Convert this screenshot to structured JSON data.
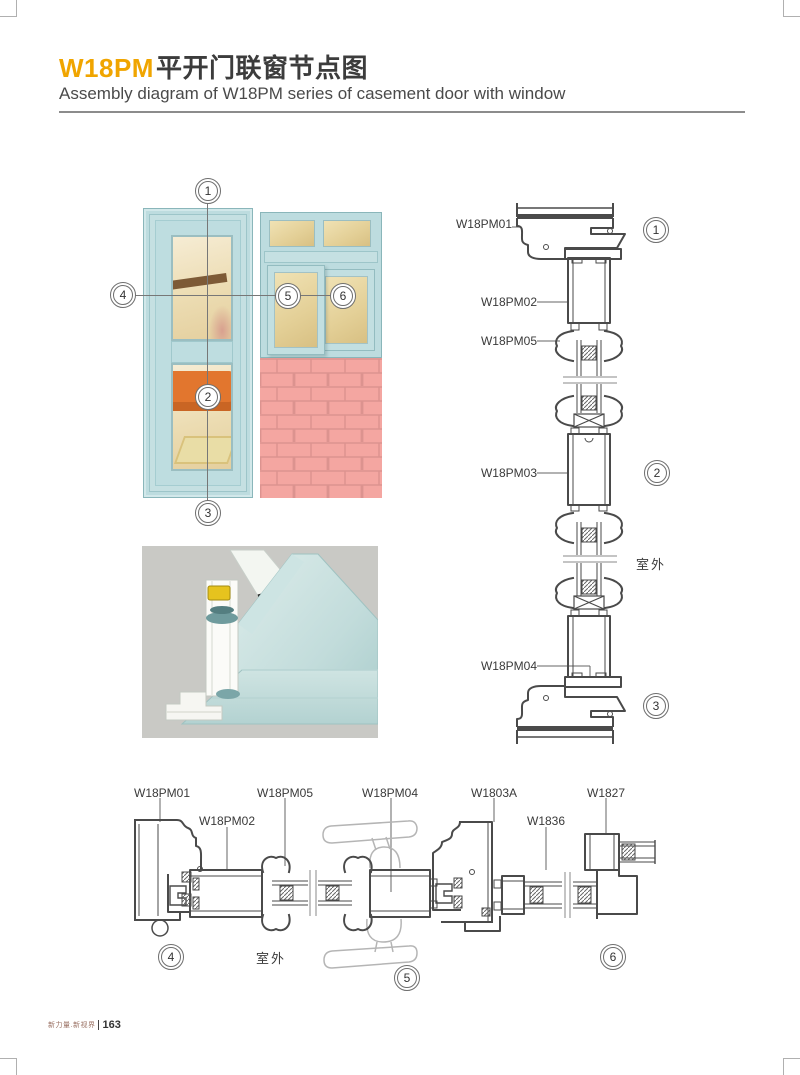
{
  "page": {
    "title_code": "W18PM",
    "title_zh": "平开门联窗节点图",
    "subtitle": "Assembly diagram of W18PM series of casement door with window",
    "footer_slogan": "新力量.新视界",
    "footer_page": "163"
  },
  "callouts": [
    "1",
    "2",
    "3",
    "4",
    "5",
    "6"
  ],
  "outdoor": "室外",
  "vertical": {
    "labels": [
      "W18PM01",
      "W18PM02",
      "W18PM05",
      "W18PM03",
      "W18PM04"
    ]
  },
  "horizontal": {
    "labels": [
      "W18PM01",
      "W18PM02",
      "W18PM05",
      "W18PM04",
      "W1803A",
      "W1836",
      "W1827"
    ]
  },
  "colors": {
    "accent_orange": "#f0a500",
    "drawing_line": "#4a4a4a",
    "frame_blue": "#bddcdf",
    "brick_pink": "#f4a6a1",
    "glass_tan": "#e8d7a2",
    "render_background": "#c9c9c5"
  }
}
